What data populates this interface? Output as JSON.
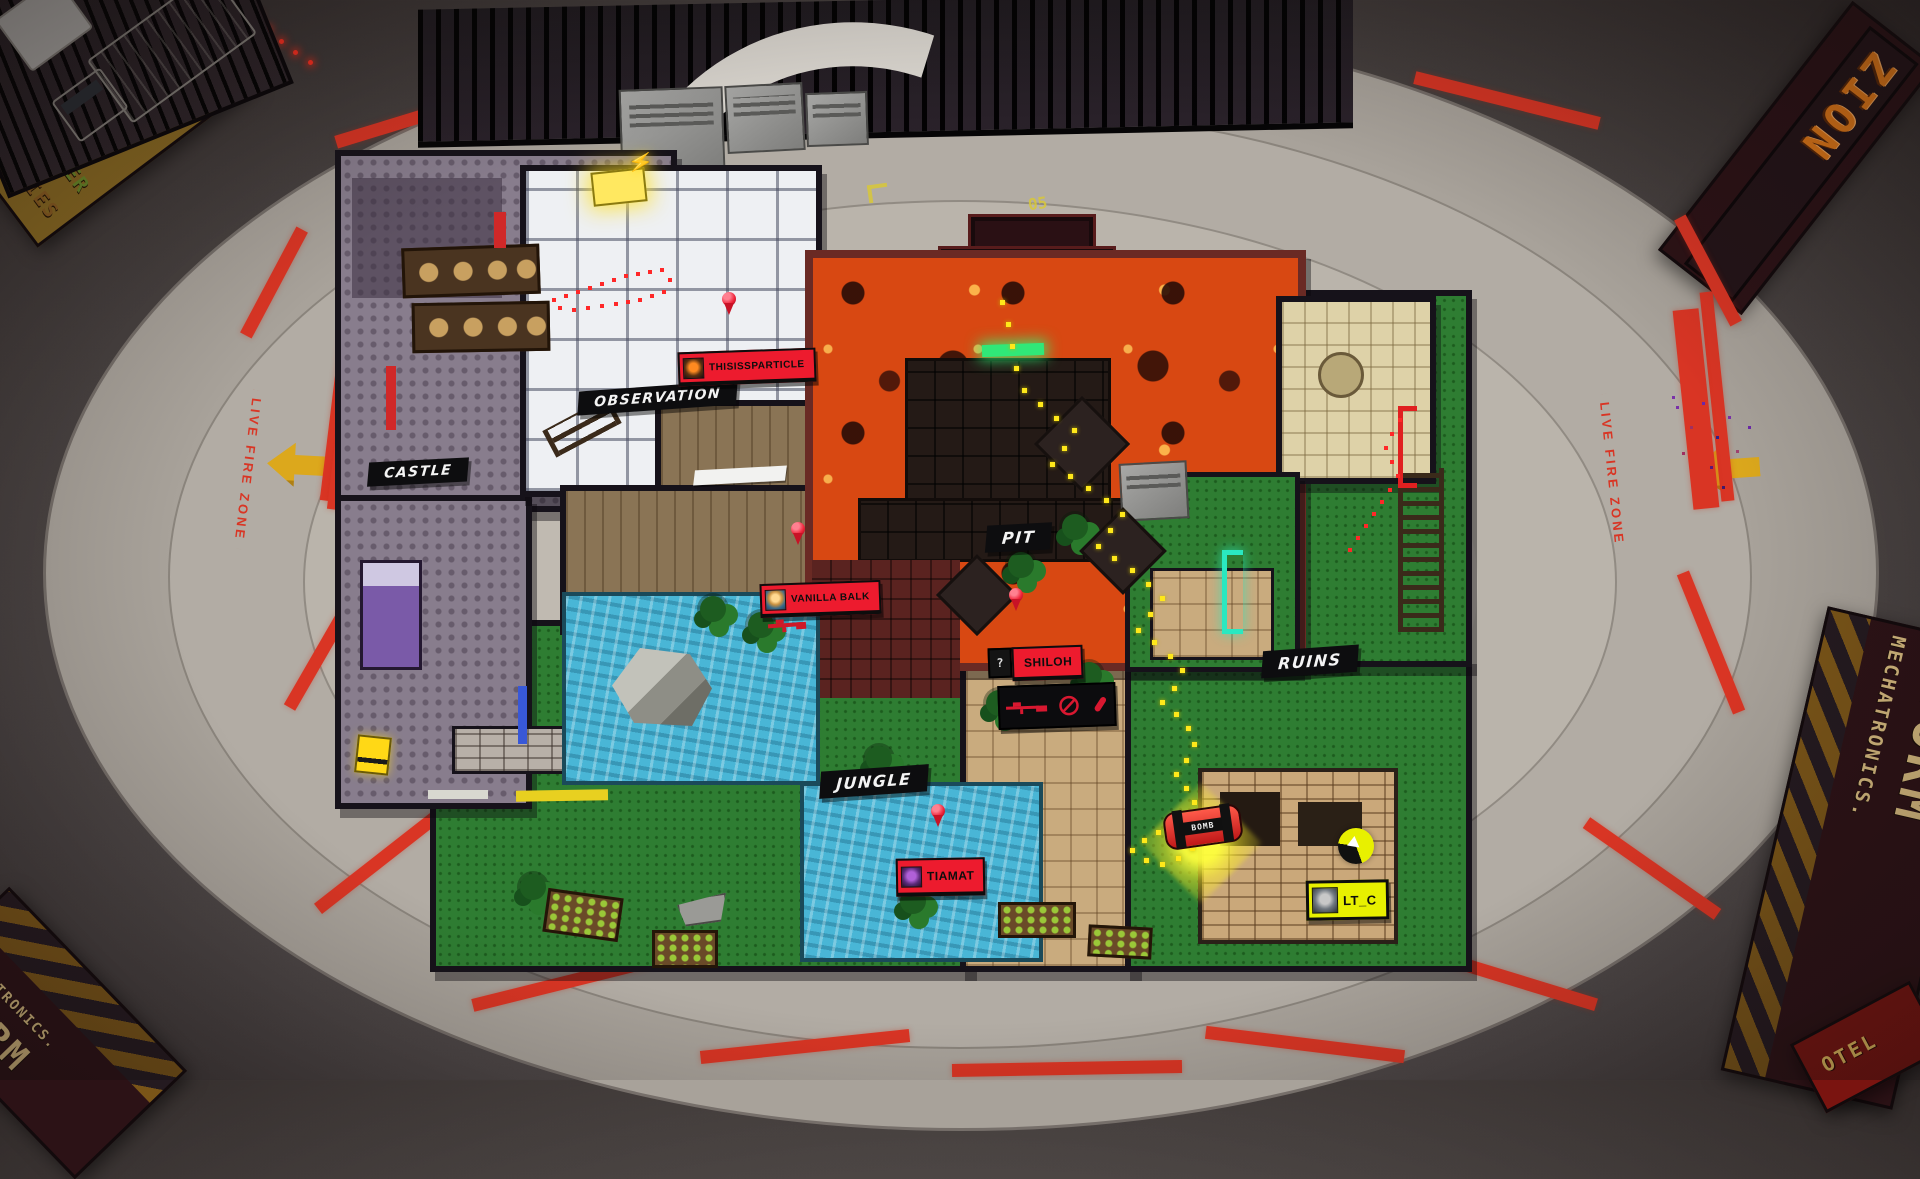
{
  "arena": {
    "live_fire_zone": "LIVE FIRE ZONE"
  },
  "zones": {
    "castle": "CASTLE",
    "observation": "OBSERVATION",
    "pit": "PIT",
    "jungle": "JUNGLE",
    "ruins": "RUINS"
  },
  "players": {
    "thisissparticle": {
      "name": "THISISSPARTICLE"
    },
    "vanilla_balk": {
      "name": "VANILLA BALK"
    },
    "shiloh": {
      "name": "SHILOH",
      "query": "?"
    },
    "tiamat": {
      "name": "TIAMAT"
    },
    "lt_c": {
      "name": "LT_C"
    }
  },
  "bomb": {
    "label": "BOMB"
  },
  "billboards": {
    "zion": "ZION",
    "storm": "STORM",
    "mechatronics": "MECHATRONICS.",
    "burger_top": "ZOMBIES",
    "burger_mid": "BURGER",
    "burger_contest": "CONTEST",
    "hotel": "OTEL",
    "stencil_05": "05"
  },
  "icons": {
    "lightning": "⚡",
    "shiloh_loadout": [
      "sniper-rifle",
      "ammo-empty",
      "magazine"
    ]
  },
  "colors": {
    "badge_red": "#ed1b2e",
    "badge_yellow": "#e8f000",
    "banner_black": "#0d0d0f",
    "live_fire": "#d93524",
    "arrow_yellow": "#dca81c",
    "lava": "#d84812",
    "water": "#49b6d6",
    "grass": "#2e7d32",
    "trail_yellow": "#ffe81a",
    "trail_red": "#ff2828",
    "pin_red": "#ee2238",
    "door_green": "#30e878",
    "door_teal": "#2ae8c0",
    "door_blue": "#3858d8"
  },
  "trails": {
    "yellow": [
      [
        1000,
        300
      ],
      [
        1006,
        322
      ],
      [
        1010,
        344
      ],
      [
        1014,
        366
      ],
      [
        1022,
        388
      ],
      [
        1038,
        402
      ],
      [
        1054,
        416
      ],
      [
        1072,
        428
      ],
      [
        1062,
        446
      ],
      [
        1050,
        462
      ],
      [
        1068,
        474
      ],
      [
        1086,
        486
      ],
      [
        1104,
        498
      ],
      [
        1120,
        512
      ],
      [
        1108,
        528
      ],
      [
        1096,
        544
      ],
      [
        1112,
        556
      ],
      [
        1130,
        568
      ],
      [
        1146,
        582
      ],
      [
        1160,
        596
      ],
      [
        1148,
        612
      ],
      [
        1136,
        628
      ],
      [
        1152,
        640
      ],
      [
        1168,
        654
      ],
      [
        1180,
        668
      ],
      [
        1172,
        686
      ],
      [
        1160,
        700
      ],
      [
        1174,
        712
      ],
      [
        1186,
        726
      ],
      [
        1192,
        742
      ],
      [
        1184,
        758
      ],
      [
        1174,
        772
      ],
      [
        1184,
        786
      ],
      [
        1192,
        800
      ],
      [
        1186,
        814
      ],
      [
        1172,
        824
      ],
      [
        1156,
        830
      ],
      [
        1142,
        838
      ],
      [
        1130,
        848
      ],
      [
        1144,
        858
      ],
      [
        1160,
        862
      ],
      [
        1176,
        856
      ],
      [
        1190,
        846
      ]
    ],
    "red_castle": [
      [
        552,
        298
      ],
      [
        564,
        294
      ],
      [
        576,
        290
      ],
      [
        588,
        286
      ],
      [
        600,
        282
      ],
      [
        612,
        278
      ],
      [
        624,
        274
      ],
      [
        636,
        272
      ],
      [
        648,
        270
      ],
      [
        660,
        268
      ],
      [
        668,
        278
      ],
      [
        662,
        290
      ],
      [
        650,
        294
      ],
      [
        638,
        298
      ],
      [
        626,
        300
      ],
      [
        614,
        302
      ],
      [
        600,
        304
      ],
      [
        586,
        306
      ],
      [
        572,
        308
      ],
      [
        558,
        306
      ]
    ],
    "red_ruins": [
      [
        1398,
        418
      ],
      [
        1390,
        432
      ],
      [
        1384,
        446
      ],
      [
        1390,
        460
      ],
      [
        1396,
        474
      ],
      [
        1388,
        488
      ],
      [
        1380,
        500
      ],
      [
        1372,
        512
      ],
      [
        1364,
        524
      ],
      [
        1356,
        536
      ],
      [
        1348,
        548
      ]
    ]
  },
  "pins": {
    "red": [
      [
        729,
        316
      ],
      [
        798,
        546
      ],
      [
        1016,
        612
      ],
      [
        938,
        828
      ]
    ]
  }
}
